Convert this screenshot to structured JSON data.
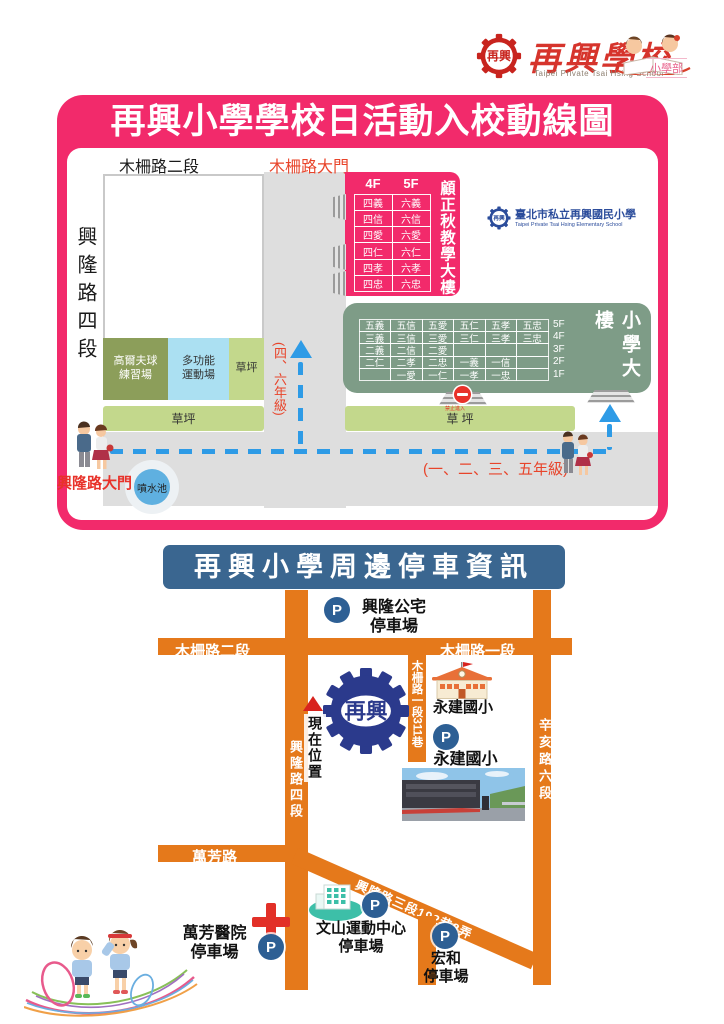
{
  "header": {
    "logo_text": "再興",
    "school_name": "再興學校",
    "school_name_en": "Taipei Private Tsai Hsing School",
    "division": "小學部"
  },
  "route_map": {
    "title": "再興小學學校日活動入校動線圖",
    "labels": {
      "muzha_rd2": "木柵路二段",
      "muzha_gate": "木柵路大門",
      "xinglong_rd4": "興隆路四段",
      "xinglong_gate": "興隆路大門",
      "golf": "高爾夫球\n練習場",
      "multi_sport": "多功能\n運動場",
      "lawn_small": "草坪",
      "lawn_bottom": "草坪",
      "lawn_right": "草 坪",
      "fountain": "噴水池",
      "no_entry": "禁止進入",
      "route_46": "(四、六年級)",
      "route_1235": "(一、二、三、五年級)"
    },
    "gu_building": {
      "name": "顧正秋教學大樓",
      "col_headers": [
        "4F",
        "5F"
      ],
      "grid": [
        [
          "四義",
          "六義"
        ],
        [
          "四信",
          "六信"
        ],
        [
          "四愛",
          "六愛"
        ],
        [
          "四仁",
          "六仁"
        ],
        [
          "四孝",
          "六孝"
        ],
        [
          "四忠",
          "六忠"
        ]
      ]
    },
    "elementary_building": {
      "name": "小學大樓",
      "floor_labels": [
        "5F",
        "4F",
        "3F",
        "2F",
        "1F"
      ],
      "grid": [
        [
          "五義",
          "五信",
          "五愛",
          "五仁",
          "五孝",
          "五忠"
        ],
        [
          "三義",
          "三信",
          "三愛",
          "三仁",
          "三孝",
          "三忠"
        ],
        [
          "二義",
          "二信",
          "二愛",
          "",
          "",
          ""
        ],
        [
          "二仁",
          "二孝",
          "二忠",
          "一義",
          "一信",
          ""
        ],
        [
          "",
          "一愛",
          "一仁",
          "一孝",
          "一忠",
          ""
        ]
      ]
    },
    "school_badge": {
      "zh": "臺北市私立再興國民小學",
      "en": "Taipei Private Tsai Hsing Elementary School"
    }
  },
  "parking_map": {
    "title": "再興小學周邊停車資訊",
    "p_label": "P",
    "logo_text": "再興",
    "current_location": "現在位置",
    "roads": {
      "muzha_rd2": "木柵路二段",
      "muzha_rd1": "木柵路一段",
      "muzha_lane311": "木柵路一段311巷",
      "xinglong_rd4": "興隆路四段",
      "xinhai_rd6": "辛亥路六段",
      "wanfang_rd": "萬芳路",
      "xinglong3_lane": "興隆路三段192巷8弄"
    },
    "landmarks": {
      "yongjian_school": "永建國小"
    },
    "parkings": {
      "xinglong_public": "興隆公宅\n停車場",
      "yongjian": "永建國小\n停車場",
      "wanfang_hospital": "萬芳醫院\n停車場",
      "wenshan_sport": "文山運動中心\n停車場",
      "honghe": "宏和\n停車場"
    }
  }
}
